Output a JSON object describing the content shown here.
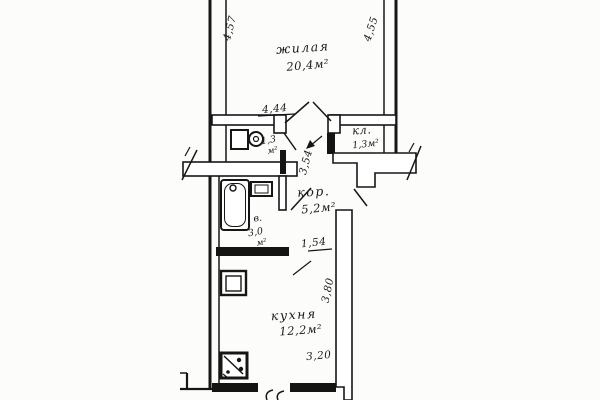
{
  "document": {
    "type": "apartment-floor-plan",
    "style": "scanned-ink-drawing"
  },
  "colors": {
    "ink": "#161616",
    "paper": "#fcfcfa"
  },
  "rooms": {
    "living": {
      "name": "жилая",
      "area": "20,4м²"
    },
    "toilet": {
      "area_value": "1,3",
      "area_unit": "м²"
    },
    "closet": {
      "name": "кл.",
      "area": "1,3м²"
    },
    "corridor": {
      "name": "кор.",
      "area": "5,2м²"
    },
    "bathroom": {
      "name": "в.",
      "area_value": "3,0",
      "area_unit": "м²"
    },
    "kitchen": {
      "name": "кухня",
      "area": "12,2м²"
    }
  },
  "dimensions": {
    "living_left_depth": "4,57",
    "living_right_depth": "4,55",
    "living_width": "4,44",
    "hall_depth": "3,54",
    "corridor_opening": "1,54",
    "kitchen_depth": "3,80",
    "kitchen_width": "3,20"
  },
  "fixtures": {
    "bathtub": "bathtub",
    "bath_sink": "wash-basin",
    "toilet": "toilet",
    "kitchen_sink": "kitchen-sink",
    "stove": "stove"
  }
}
